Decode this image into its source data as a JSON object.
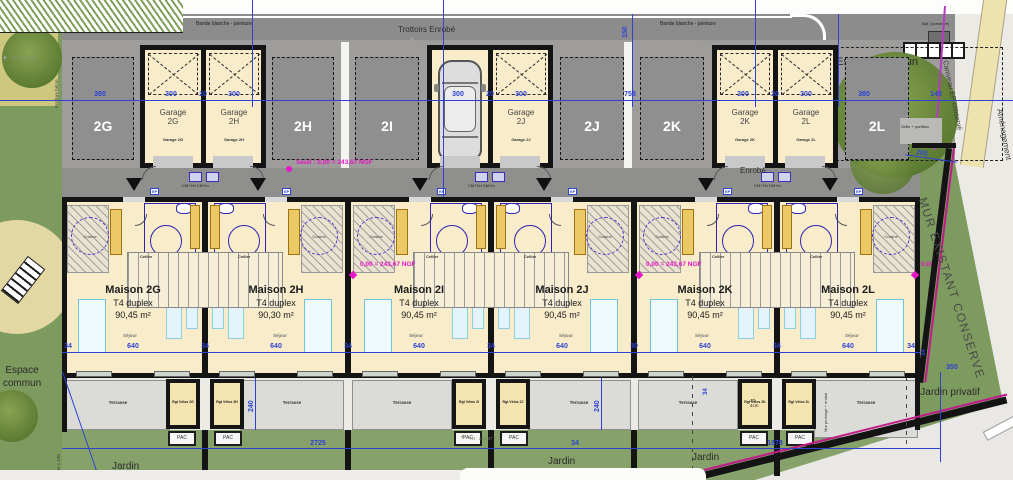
{
  "colors": {
    "dim_blue": "#2e43d4",
    "magenta": "#e616c6",
    "cream": "#f8ecca",
    "court_gray": "#9e9d9b",
    "road_gray": "#8c8c8c",
    "green": "#7d9a5f",
    "terrace_gray": "#dbdbd8",
    "wall_black": "#141414",
    "accent_line": "#c21a8a"
  },
  "site": {
    "bande_blanche": "Bande blanche - peinture",
    "trottoirs": "Trottoirs Enrobé",
    "enrobe": "Enrobé",
    "espace_commun": "Espace commun",
    "jardin": "Jardin",
    "jardin_privatif": "Jardin privatif",
    "mur_existant": "MUR EXISTANT CONSERVE",
    "caniveau": "Caniveau EP conservé",
    "amenagement": "Aménagement",
    "grille_portillon": "Grille + portillon",
    "bat_conserve": "Bât. (conservé)",
    "bordure_beton": "Bordure béton",
    "mur_prolonge": "Mur prolongé + enduit",
    "jd_line1": "JD",
    "jd_line2": "4cm",
    "h120": "H = 120"
  },
  "levels": {
    "seuil": "Seuil : 0,00 = 243,67 NGF",
    "ngf": "0,00 = 243,67 NGF",
    "ngf_short": "0,00",
    "tn_top": "TN : 243,13",
    "tn_left": "TN : 243,79",
    "tn_jardin": "TN : 243,37"
  },
  "parking": {
    "labels": [
      "2G",
      "2H",
      "2I",
      "2J",
      "2K",
      "2L"
    ]
  },
  "garages": [
    {
      "title": "Garage",
      "unit": "2G",
      "sub": "Garage 2G"
    },
    {
      "title": "Garage",
      "unit": "2H",
      "sub": "Garage 2H"
    },
    {
      "title": "Garage",
      "unit": "2I",
      "sub": "Garage 2I"
    },
    {
      "title": "Garage",
      "unit": "2J",
      "sub": "Garage 2J"
    },
    {
      "title": "Garage",
      "unit": "2K",
      "sub": "Garage 2K"
    },
    {
      "title": "Garage",
      "unit": "2L",
      "sub": "Garage 2L"
    }
  ],
  "houses": [
    {
      "name": "Maison 2G",
      "type": "T4 duplex",
      "area": "90,45 m²"
    },
    {
      "name": "Maison 2H",
      "type": "T4 duplex",
      "area": "90,30 m²"
    },
    {
      "name": "Maison 2I",
      "type": "T4 duplex",
      "area": "90,45 m²"
    },
    {
      "name": "Maison 2J",
      "type": "T4 duplex",
      "area": "90,45 m²"
    },
    {
      "name": "Maison 2K",
      "type": "T4 duplex",
      "area": "90,45 m²"
    },
    {
      "name": "Maison 2L",
      "type": "T4 duplex",
      "area": "90,45 m²"
    }
  ],
  "rooms": {
    "cuisine": "Cuisine",
    "cellier": "Cellier",
    "sejour": "Séjour"
  },
  "annex": {
    "terrasse": "Terrasse",
    "pac": "PAC",
    "ep": "EP",
    "coffret": "CM+Tel CM+In",
    "sheds": [
      "Rgt Vélos 2G",
      "Rgt Vélos 2H",
      "Rgt Vélos 2I",
      "Rgt Vélos 2J",
      "Rgt Vélos 2K",
      "Rgt Vélos 2L"
    ]
  },
  "dims": {
    "left380": "380",
    "g300": "300",
    "g20": "20",
    "gap758": "758",
    "right380": "380",
    "d140": "140",
    "v150": "150",
    "w34": "34",
    "w30": "30",
    "house640": "640",
    "t240": "240",
    "t34": "34",
    "j2725": "2725",
    "j34": "34",
    "j1878": "1878",
    "p350": "350",
    "r205": "205",
    "r34": "34"
  }
}
